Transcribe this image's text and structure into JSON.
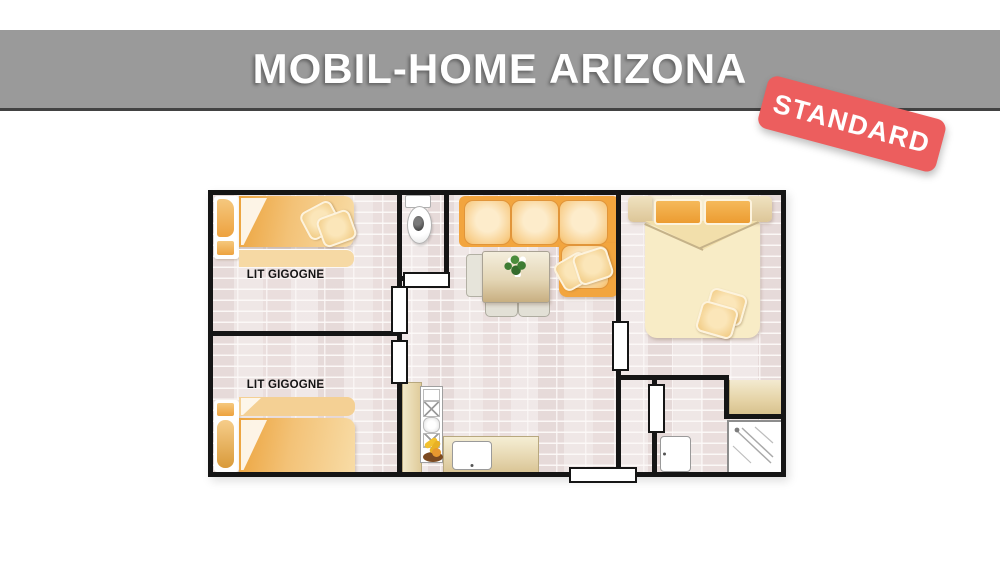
{
  "header": {
    "title": "MOBIL-HOME ARIZONA",
    "background_color": "#9a9a9a"
  },
  "badge": {
    "label": "STANDARD",
    "background_color": "#ec5e5e",
    "text_color": "#ffffff",
    "rotation_deg": 15
  },
  "floorplan": {
    "labels": {
      "bedroom_top": "LIT GIGOGNE",
      "bedroom_bottom": "LIT GIGOGNE"
    },
    "colors": {
      "wall": "#151515",
      "floor": "#efe7e6",
      "floor_brick": "#e2d5d4",
      "sofa_orange": "#f2a53e",
      "bed_orange": "#eda846",
      "bed_cream": "#f8ecc6",
      "furniture_beige": "#e7d7b0",
      "plant_green": "#3e7c33"
    },
    "icons": [
      "toilet-icon",
      "corner-sofa-icon",
      "dining-table-icon",
      "plant-icon",
      "single-bed-icon",
      "double-bed-icon",
      "kitchen-column-icon",
      "fruit-bowl-icon",
      "sink-icon",
      "washbasin-icon",
      "shower-icon",
      "door-opening-icon"
    ]
  }
}
